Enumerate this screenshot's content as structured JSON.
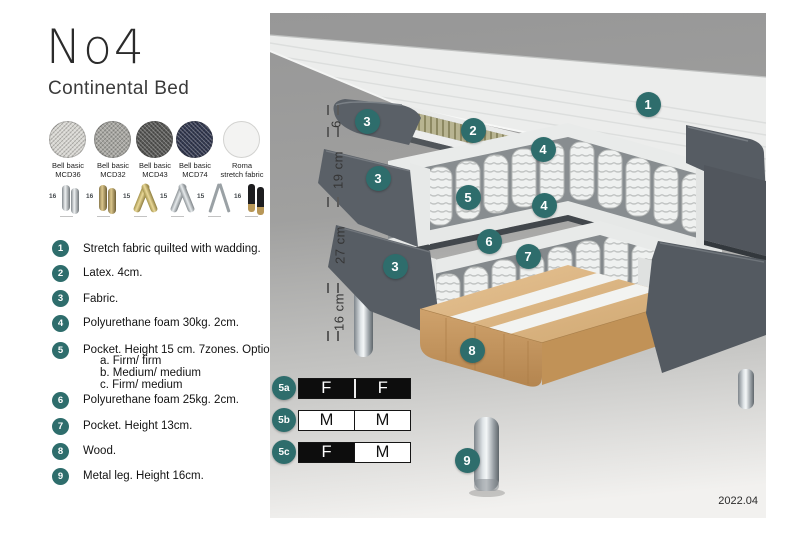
{
  "title": "No4",
  "subtitle": "Continental Bed",
  "accent_color": "#2e6d6c",
  "fabrics": [
    {
      "line1": "Bell basic",
      "line2": "MCD36",
      "color": "#d8d7d2"
    },
    {
      "line1": "Bell basic",
      "line2": "MCD32",
      "color": "#a7a6a1"
    },
    {
      "line1": "Bell basic",
      "line2": "MCD43",
      "color": "#575755"
    },
    {
      "line1": "Bell basic",
      "line2": "MCD74",
      "color": "#333950"
    },
    {
      "line1": "Roma",
      "line2": "stretch fabric",
      "color": "#f3f3f2"
    }
  ],
  "leg_options": [
    {
      "height": "16",
      "style": "chrome-cylinder-pair"
    },
    {
      "height": "16",
      "style": "brass-cylinder-pair"
    },
    {
      "height": "15",
      "style": "gold-cross"
    },
    {
      "height": "15",
      "style": "silver-cross"
    },
    {
      "height": "15",
      "style": "hairpin"
    },
    {
      "height": "16",
      "style": "black-with-brass-tip"
    }
  ],
  "features": [
    {
      "num": "1",
      "text": "Stretch fabric quilted with wadding."
    },
    {
      "num": "2",
      "text": "Latex. 4cm."
    },
    {
      "num": "3",
      "text": "Fabric."
    },
    {
      "num": "4",
      "text": "Polyurethane foam 30kg. 2cm."
    },
    {
      "num": "5",
      "text": "Pocket. Height 15 cm. 7zones. Option:",
      "sub": [
        "a. Firm/ firm",
        "b. Medium/ medium",
        "c. Firm/ medium"
      ]
    },
    {
      "num": "6",
      "text": "Polyurethane foam 25kg. 2cm."
    },
    {
      "num": "7",
      "text": "Pocket. Height 13cm."
    },
    {
      "num": "8",
      "text": "Wood."
    },
    {
      "num": "9",
      "text": "Metal leg. Height 16cm."
    }
  ],
  "measurements": [
    {
      "label": "6"
    },
    {
      "label": "19 cm"
    },
    {
      "label": "27 cm"
    },
    {
      "label": "16 cm"
    }
  ],
  "diagram_markers": {
    "m1": "1",
    "m2": "2",
    "m3a": "3",
    "m3b": "3",
    "m3c": "3",
    "m4a": "4",
    "m4b": "4",
    "m5": "5",
    "m6": "6",
    "m7": "7",
    "m8": "8",
    "m9": "9"
  },
  "firmness": [
    {
      "label": "5a",
      "cells": [
        {
          "text": "F",
          "variant": "dark"
        },
        {
          "text": "F",
          "variant": "dark"
        }
      ]
    },
    {
      "label": "5b",
      "cells": [
        {
          "text": "M",
          "variant": "light"
        },
        {
          "text": "M",
          "variant": "light"
        }
      ]
    },
    {
      "label": "5c",
      "cells": [
        {
          "text": "F",
          "variant": "dark"
        },
        {
          "text": "M",
          "variant": "light"
        }
      ]
    }
  ],
  "version": "2022.04"
}
